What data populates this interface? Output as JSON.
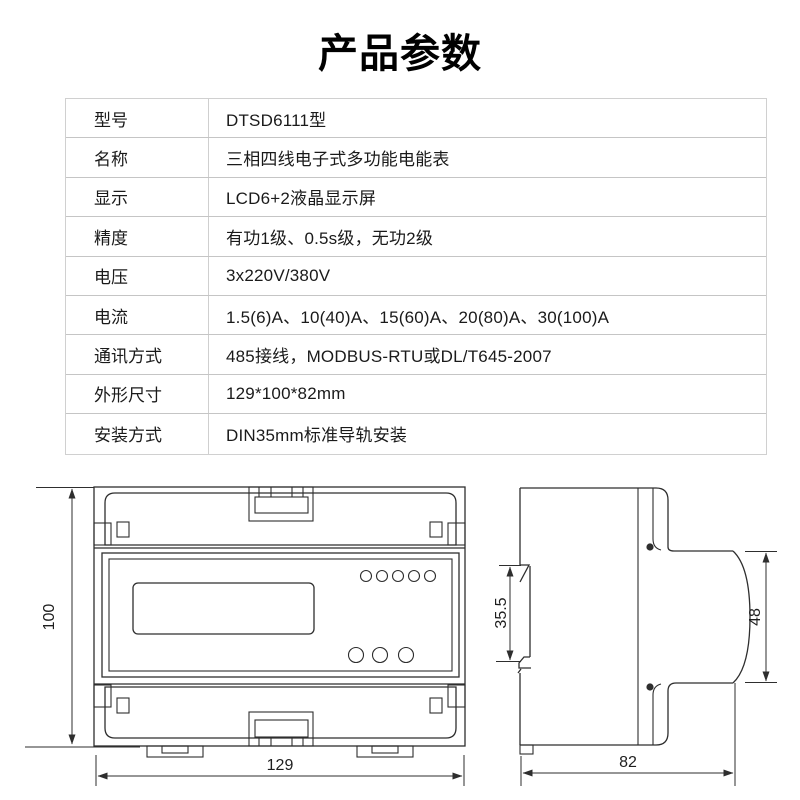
{
  "page": {
    "title": "产品参数",
    "background": "#ffffff"
  },
  "table": {
    "rows": [
      {
        "label": "型号",
        "value": "DTSD6111型"
      },
      {
        "label": "名称",
        "value": "三相四线电子式多功能电能表"
      },
      {
        "label": "显示",
        "value": "LCD6+2液晶显示屏"
      },
      {
        "label": "精度",
        "value": "有功1级、0.5s级，无功2级"
      },
      {
        "label": "电压",
        "value": "3x220V/380V"
      },
      {
        "label": "电流",
        "value": "1.5(6)A、10(40)A、15(60)A、20(80)A、30(100)A"
      },
      {
        "label": "通讯方式",
        "value": "485接线，MODBUS-RTU或DL/T645-2007"
      },
      {
        "label": "外形尺寸",
        "value": "129*100*82mm"
      },
      {
        "label": "安装方式",
        "value": "DIN35mm标准导轨安装"
      }
    ]
  },
  "drawing": {
    "front_view": {
      "height_mm": "100",
      "width_mm": "129"
    },
    "side_view": {
      "din_slot_mm": "35.5",
      "face_mm": "48",
      "depth_mm": "82"
    },
    "line_color": "#2e2e2e"
  }
}
